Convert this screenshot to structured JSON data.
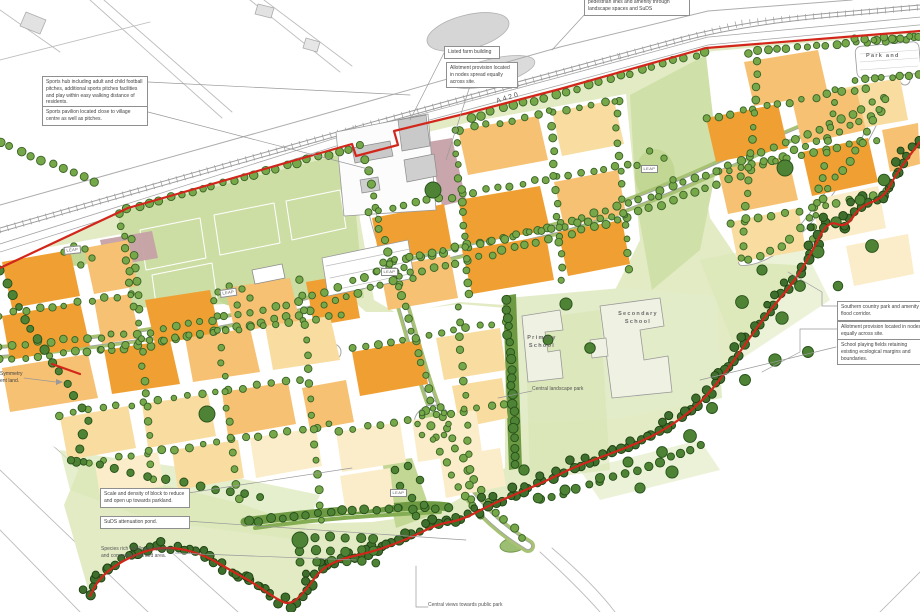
{
  "map": {
    "road_label": "A420",
    "park_and_label": "Park and",
    "leap_label": "LEAP",
    "primary_school": "Primary School",
    "secondary_school": "Secondary School",
    "central_landscape_park": "Central landscape park",
    "central_views": "Central views towards public park"
  },
  "annotations": {
    "pedestrian_links": "pedestrian links and amenity through landscape spaces and SuDS",
    "sports_hub": "Sports hub including adult and child football pitches, additional sports pitches facilities and play within easy walking distance of residents.",
    "sports_pavilion": "Sports pavilion located close to village centre as well as pitches.",
    "listed_farm": "Listed farm building",
    "allotment_top": "Allotment provision located in nodes spread equally across site.",
    "southern_park": "Southern country park and amenity in flood corridor.",
    "allotment_right": "Allotment provision located in nodes equally across site.",
    "school_fields": "School playing fields retaining existing ecological margins and boundaries.",
    "symmetry_line1": "Symmetry",
    "symmetry_line2": "ent land.",
    "scale_density": "Scale and density of block to reduce and open up towards parkland.",
    "suds_pond": "SuDS attenuation pond.",
    "wildflower": "Species rich wildflower meadow and community orchard area."
  },
  "colors": {
    "boundary_red": "#D3261B",
    "block_dark": "#F0A033",
    "block_mid": "#F6C172",
    "block_light": "#F9DCA0",
    "block_pale": "#FBEDC9",
    "park_green": "#E2EBC4",
    "pitch_green": "#CCDEA4",
    "leap_green": "#C3D795",
    "verge_green": "#A6C272",
    "hedge_green": "#6F9A44",
    "mauve": "#C6A1A6",
    "road_casing": "#A5A5A5",
    "context_grey": "#BDBDBD"
  }
}
